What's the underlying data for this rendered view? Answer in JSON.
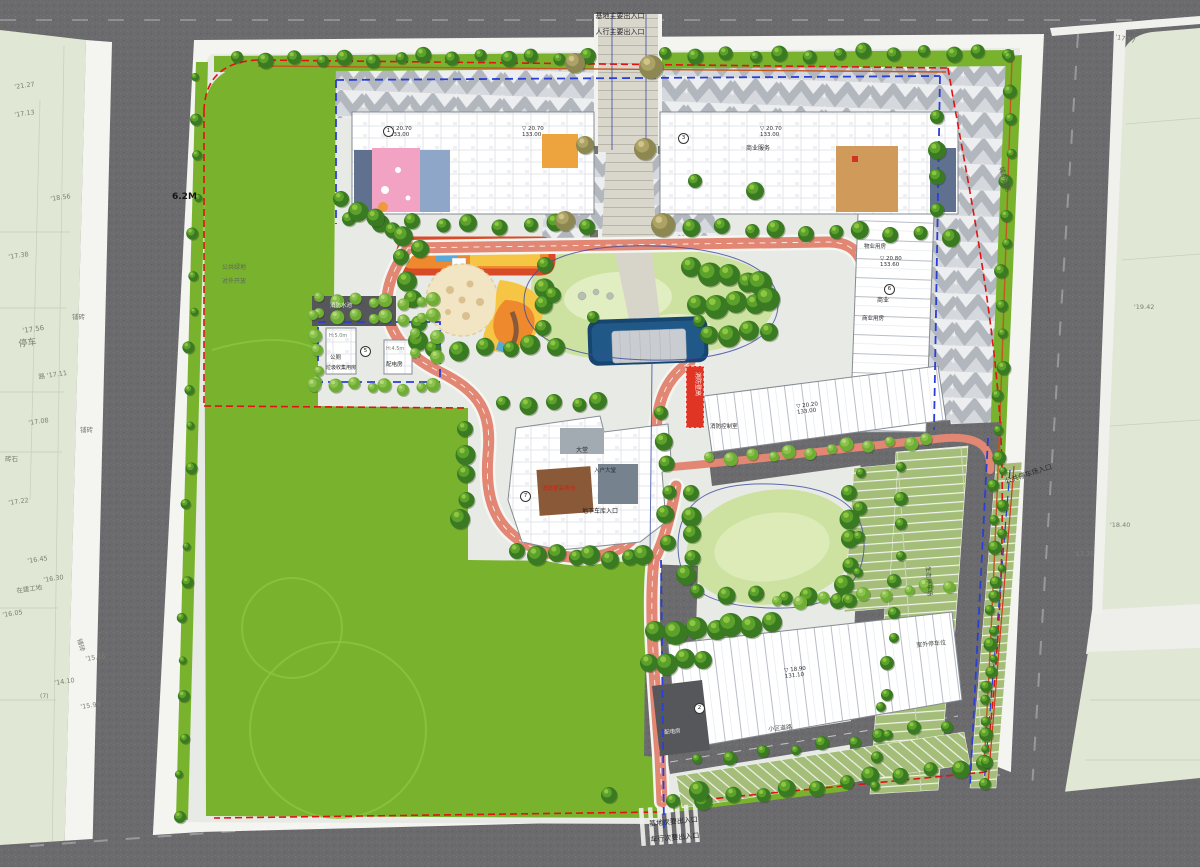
{
  "map": {
    "type": "residential-masterplan-siteplan"
  },
  "entrances": {
    "main_line1": "基地主要出入口",
    "main_line2": "人行主要出入口",
    "secondary_line1": "基地次要出入口",
    "secondary_line2": "车行次要出入口",
    "public_parking": "公共停车场入口"
  },
  "site": {
    "setback": "6.2M",
    "public_green_1": "公共绿地",
    "public_green_2": "对外开放",
    "city_road": "城市道路"
  },
  "colors": {
    "boundary_red": "#e01212",
    "setback_blue": "#2a3fd6",
    "site_lawn": "#79b32e",
    "central_lawn": "#cde2a0",
    "water": "#16466f",
    "fire_lane": "#e28774",
    "asphalt": "#6a6a6d",
    "offsite_parcel": "#e0e7d4",
    "kindergarten_pink": "#f2a2c2",
    "kindergarten_blue": "#8ea6c8",
    "kindergarten_orange": "#eda43e",
    "tan_room": "#cf9a5a",
    "playground_orange": "#ee8a2d",
    "playground_yellow": "#f6c544",
    "track_red": "#d84b28"
  },
  "annotations": [
    {
      "t": "'21.27",
      "x": 14,
      "y": 84,
      "r": -8
    },
    {
      "t": "'17.13",
      "x": 14,
      "y": 112,
      "r": -8
    },
    {
      "t": "'18.56",
      "x": 50,
      "y": 196,
      "r": -8
    },
    {
      "t": "'17.38",
      "x": 8,
      "y": 254,
      "r": -8
    },
    {
      "t": "铺砖",
      "x": 72,
      "y": 314
    },
    {
      "t": "'17.56",
      "x": 22,
      "y": 328,
      "r": -8,
      "s": 7
    },
    {
      "t": "停车",
      "x": 18,
      "y": 340,
      "r": -8,
      "s": 9
    },
    {
      "t": "路 '17.11",
      "x": 38,
      "y": 374,
      "r": -8
    },
    {
      "t": "'17.08",
      "x": 28,
      "y": 420,
      "r": -8
    },
    {
      "t": "铺砖",
      "x": 80,
      "y": 427
    },
    {
      "t": "砖石",
      "x": 5,
      "y": 456
    },
    {
      "t": "'17.22",
      "x": 8,
      "y": 500,
      "r": -8
    },
    {
      "t": "'16.45",
      "x": 27,
      "y": 558,
      "r": -8
    },
    {
      "t": "'16.30",
      "x": 43,
      "y": 577,
      "r": -8
    },
    {
      "t": "在建工地",
      "x": 16,
      "y": 588,
      "r": -8
    },
    {
      "t": "'16.05",
      "x": 2,
      "y": 612,
      "r": -8
    },
    {
      "t": "铺砖",
      "x": 82,
      "y": 638,
      "r": 75
    },
    {
      "t": "'15.16",
      "x": 85,
      "y": 656,
      "r": -8
    },
    {
      "t": "'14.10",
      "x": 54,
      "y": 680,
      "r": -8
    },
    {
      "t": "(7)",
      "x": 40,
      "y": 694,
      "s": 6
    },
    {
      "t": "'15.99",
      "x": 80,
      "y": 704,
      "r": -8
    },
    {
      "t": "'17.17",
      "x": 1116,
      "y": 34,
      "r": 12
    },
    {
      "t": "'19.42",
      "x": 1134,
      "y": 304
    },
    {
      "t": "'18.40",
      "x": 1110,
      "y": 522
    },
    {
      "t": "'17.75",
      "x": 1074,
      "y": 551
    },
    {
      "t": "▽ 20.70\n133.00",
      "x": 390,
      "y": 126,
      "s": 5.5,
      "c": "#2e2e2e"
    },
    {
      "t": "▽ 20.70\n133.00",
      "x": 522,
      "y": 126,
      "s": 5.5,
      "c": "#2e2e2e"
    },
    {
      "t": "▽ 20.70\n133.00",
      "x": 760,
      "y": 126,
      "s": 5.5,
      "c": "#2e2e2e"
    },
    {
      "t": "▽ 20.80\n133.60",
      "x": 880,
      "y": 256,
      "s": 5.5,
      "c": "#2e2e2e"
    },
    {
      "t": "▽ 20.20\n133.00",
      "x": 796,
      "y": 404,
      "s": 5.5,
      "c": "#2e2e2e",
      "r": -7
    },
    {
      "t": "▽ 18.90\n131.10",
      "x": 784,
      "y": 668,
      "s": 5.5,
      "c": "#2e2e2e",
      "r": -6
    },
    {
      "t": "商业服务",
      "x": 746,
      "y": 146,
      "s": 6,
      "c": "#2e2e2e"
    },
    {
      "t": "物业用房",
      "x": 864,
      "y": 244,
      "s": 5.5,
      "c": "#2e2e2e"
    },
    {
      "t": "商业",
      "x": 877,
      "y": 298,
      "s": 6,
      "c": "#2e2e2e"
    },
    {
      "t": "商业用房",
      "x": 862,
      "y": 316,
      "s": 5.5,
      "c": "#2e2e2e"
    },
    {
      "t": "消防水池",
      "x": 330,
      "y": 303,
      "s": 5.5,
      "c": "#f0f0ec"
    },
    {
      "t": "H:5.0m",
      "x": 329,
      "y": 334,
      "s": 5
    },
    {
      "t": "公厕",
      "x": 330,
      "y": 355,
      "s": 5.5,
      "c": "#2e2e2e"
    },
    {
      "t": "垃圾收集用房",
      "x": 326,
      "y": 366,
      "s": 5,
      "c": "#2e2e2e"
    },
    {
      "t": "H:4.5m",
      "x": 386,
      "y": 347,
      "s": 5
    },
    {
      "t": "配电房",
      "x": 386,
      "y": 362,
      "s": 5.5,
      "c": "#2e2e2e"
    },
    {
      "t": "大堂",
      "x": 576,
      "y": 448,
      "s": 6,
      "c": "#2e2e2e"
    },
    {
      "t": "入户大堂",
      "x": 594,
      "y": 468,
      "s": 5.5,
      "c": "#2e2e2e"
    },
    {
      "t": "消防登高场地",
      "x": 542,
      "y": 486,
      "s": 5.5,
      "c": "#cc2211"
    },
    {
      "t": "地下车库入口",
      "x": 582,
      "y": 509,
      "s": 6,
      "c": "#1d1d1d"
    },
    {
      "t": "消防控制室",
      "x": 710,
      "y": 424,
      "s": 5.5,
      "c": "#2e2e2e"
    },
    {
      "t": "消防登高",
      "x": 700,
      "y": 372,
      "s": 6,
      "c": "#ffffff",
      "r": 90
    },
    {
      "t": "小区道路",
      "x": 768,
      "y": 727,
      "s": 6,
      "c": "#4a4a4a",
      "r": -5
    },
    {
      "t": "配电房",
      "x": 664,
      "y": 730,
      "s": 5.5,
      "c": "#eeeeee",
      "r": -5
    },
    {
      "t": "生态停车场",
      "x": 930,
      "y": 566,
      "s": 6,
      "c": "#3f4a3f",
      "r": 86
    },
    {
      "t": "室外停车位",
      "x": 916,
      "y": 643,
      "s": 6,
      "c": "#3f4a3f",
      "r": -5
    }
  ],
  "markers": [
    {
      "x": 383,
      "y": 126,
      "n": "1"
    },
    {
      "x": 678,
      "y": 133,
      "n": "3"
    },
    {
      "x": 884,
      "y": 284,
      "n": "6"
    },
    {
      "x": 520,
      "y": 491,
      "n": "7"
    },
    {
      "x": 694,
      "y": 703,
      "n": "2"
    },
    {
      "x": 360,
      "y": 346,
      "n": "5"
    }
  ]
}
